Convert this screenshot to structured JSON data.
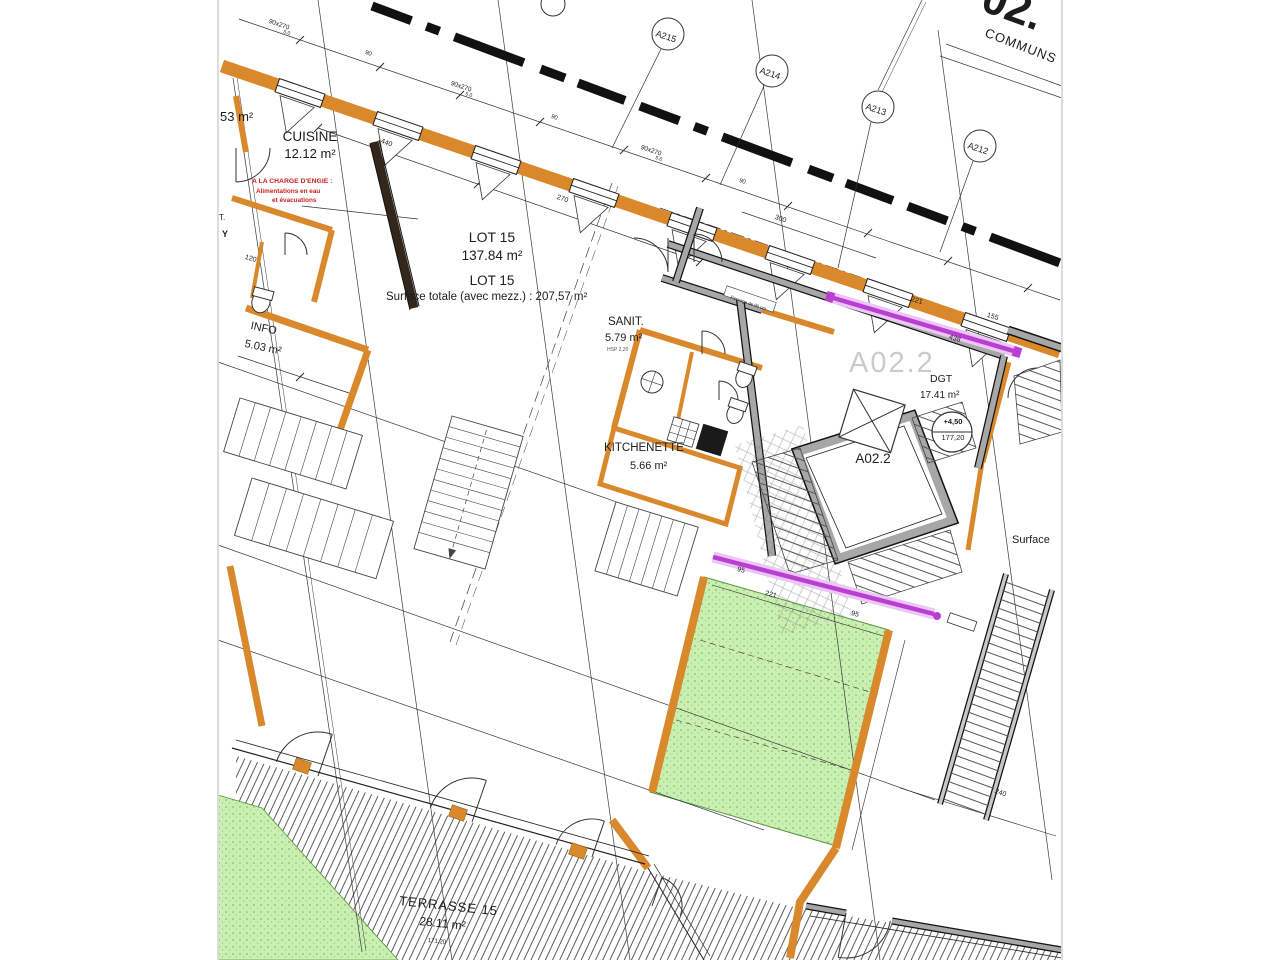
{
  "colors": {
    "wall_orange": "#d9892c",
    "wall_gray": "#a7a7a7",
    "wall_dark": "#33261a",
    "glass_magenta": "#b93fd1",
    "green_area": "#c9f0b2",
    "red_note": "#cc2020",
    "watermark_gray": "#cbcbcb"
  },
  "titles": {
    "big_partial": "02.",
    "communs": "COMMUNS",
    "watermark": "A02.2"
  },
  "rooms": {
    "partial53": {
      "area": "53 m²"
    },
    "cuisine": {
      "name": "CUISINE",
      "area": "12.12 m²"
    },
    "lot15": {
      "name": "LOT 15",
      "area": "137.84 m²"
    },
    "lot15_total": {
      "name": "LOT 15",
      "note": "Surface totale (avec mezz.) : 207,57 m²"
    },
    "info": {
      "name": "INFO",
      "area": "5.03 m²"
    },
    "sanit": {
      "name": "SANIT.",
      "area": "5.79 m²",
      "sub": "HSP 2,20"
    },
    "kitchenette": {
      "name": "KITCHENETTE",
      "area": "5.66 m²"
    },
    "dgt": {
      "name": "DGT",
      "area": "17.41 m²"
    },
    "stair": {
      "name": "A02.2"
    },
    "terrasse": {
      "name": "TERRASSE 15",
      "area": "28.11 m²",
      "level": "171,20"
    }
  },
  "red_note": {
    "l1": "A LA CHARGE D'ENGIE :",
    "l2": "Alimentations en eau",
    "l3": "et évacuations"
  },
  "grid_bubbles": [
    {
      "id": "A215"
    },
    {
      "id": "A214"
    },
    {
      "id": "A213"
    },
    {
      "id": "A212"
    }
  ],
  "elevation": {
    "top": "+4,50",
    "bottom": "177,20"
  },
  "partial_labels": {
    "surface": "Surface",
    "t": "T.",
    "y": "Y"
  },
  "passage_note": "Passage de 90 cm",
  "facade_dims": {
    "win": "90x270",
    "gap": "90",
    "sub": "5.0"
  },
  "dims": [
    {
      "t": "440"
    },
    {
      "t": "270"
    },
    {
      "t": "300"
    },
    {
      "t": "120"
    },
    {
      "t": "221"
    },
    {
      "t": "438"
    },
    {
      "t": "155"
    },
    {
      "t": "95"
    },
    {
      "t": "221"
    },
    {
      "t": "95"
    },
    {
      "t": "240"
    }
  ]
}
